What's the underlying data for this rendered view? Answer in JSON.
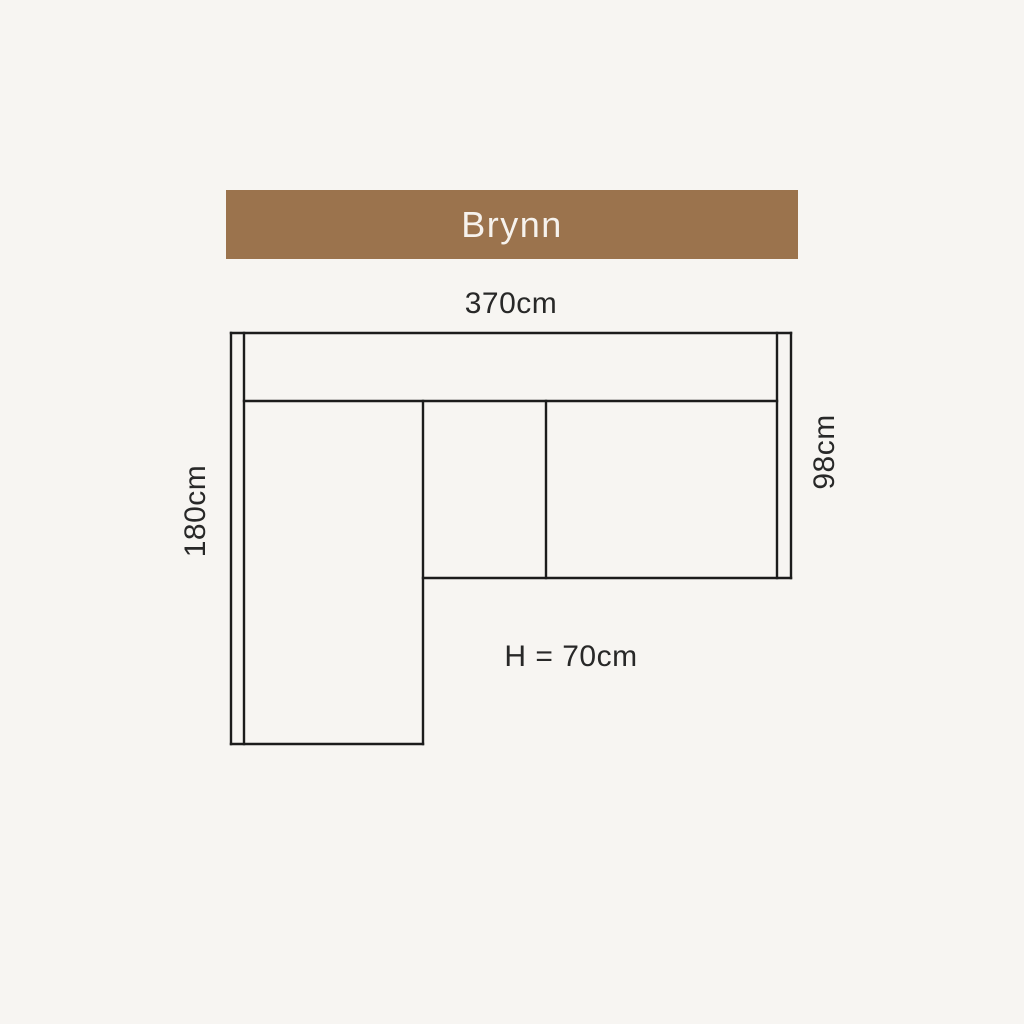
{
  "page": {
    "background": "#F7F5F2"
  },
  "banner": {
    "title": "Brynn",
    "background": "#9B734D",
    "text_color": "#F6F2ED"
  },
  "diagram": {
    "type": "sofa-top-view-dimension-drawing",
    "product_name": "Brynn",
    "line_color": "#1C1C1C",
    "label_color": "#282828",
    "labels": {
      "total_width": "370cm",
      "depth": "98cm",
      "chaise_length": "180cm",
      "seat_height": "H = 70cm"
    }
  }
}
